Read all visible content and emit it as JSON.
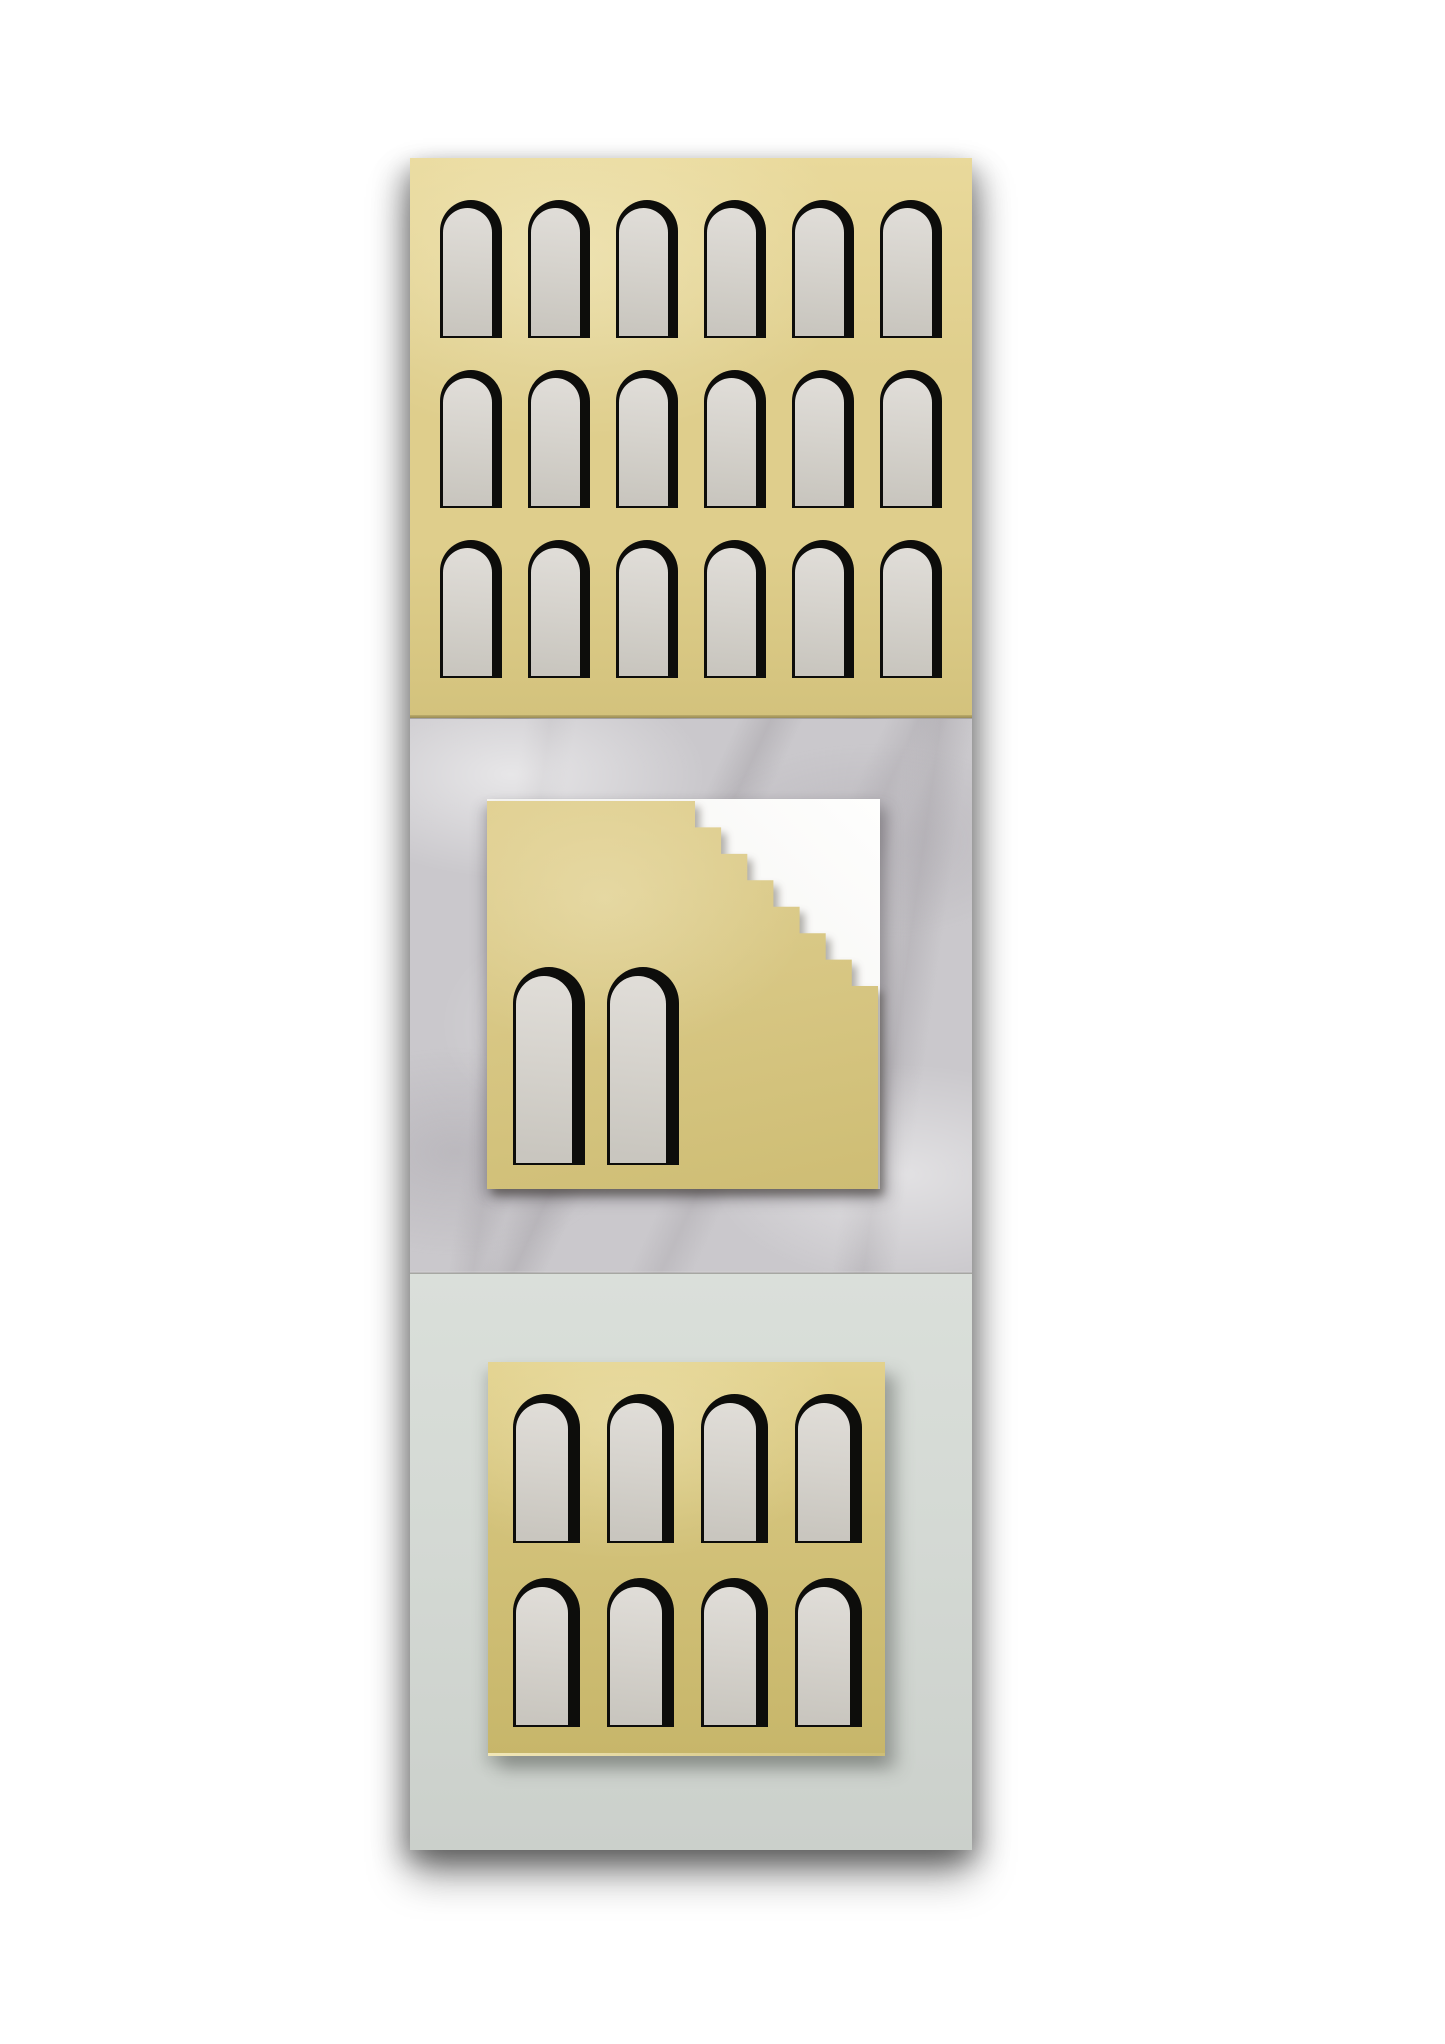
{
  "alt": "Architectural wall relief artwork: vertical panel of three stacked sections — brass plate with three rows of six arched cutouts; white Carrara marble with a square brass plaque cut by a seven-step staircase notch over a white acrylic plate, with two arched cutouts; pale sage panel with a square brass plaque with two rows of four arched cutouts.",
  "sections": {
    "top": "brass arcade plate, 18 arch cutouts (3 rows x 6 columns)",
    "middle": "marble slab with brass plaque, staircase notch and 2 arch cutouts",
    "bottom": "sage panel with brass plaque, 8 arch cutouts (2 rows x 4 columns)"
  },
  "colors": {
    "background": "#ffffff",
    "gold_top_light": "#e9d99b",
    "gold_top": "#dfce8c",
    "gold_top_dark": "#d3c27c",
    "gold_mid_light": "#e0cf90",
    "gold_mid": "#d8c784",
    "gold_mid_dark": "#cebd74",
    "gold_bot_light": "#e2d18c",
    "gold_bot": "#d3c27a",
    "gold_bot_dark": "#c7b66a",
    "cut_black": "#0d0d0b",
    "recess_light": "#dfdcd7",
    "recess_mid": "#d6d3cd",
    "recess_dark": "#c9c6bf",
    "marble_base": "#cac8cc",
    "white_plate_light": "#fefefd",
    "white_plate": "#f5f4f2",
    "white_plate_dark": "#e9e8e5",
    "sage": "#d4d9d4",
    "sage_light": "#dadfda",
    "sage_dark": "#cbd0cb",
    "edge_bright": "#f1e7b8"
  },
  "grids": {
    "top": {
      "rows": 3,
      "cols": 6,
      "arch_w": 62,
      "arch_h": 138,
      "pitch_x": 88,
      "row_pitch": 170,
      "offset_x": 30,
      "offset_y": 42,
      "inset": {
        "left": 3,
        "right": 10,
        "top": 8,
        "bottom": 2
      }
    },
    "middle": {
      "rows": 1,
      "cols": 2,
      "arch_w": 72,
      "arch_h": 198,
      "pitch_x": 94,
      "row_pitch": 0,
      "offset_x": 26,
      "offset_y": 166,
      "inset": {
        "left": 3,
        "right": 13,
        "top": 9,
        "bottom": 2
      }
    },
    "bottom": {
      "rows": 2,
      "cols": 4,
      "arch_w": 67,
      "arch_h": 149,
      "pitch_x": 94,
      "row_pitch": 184,
      "offset_x": 25,
      "offset_y": 32,
      "inset": {
        "left": 3,
        "right": 12,
        "top": 9,
        "bottom": 2
      }
    }
  },
  "staircase": {
    "start_x": 208,
    "steps": 7,
    "step_w": 26.14,
    "step_h": 26.43,
    "plate_w": 391,
    "plate_h": 388
  },
  "arch_counts": {
    "top": 18,
    "middle": 2,
    "bottom": 8
  }
}
